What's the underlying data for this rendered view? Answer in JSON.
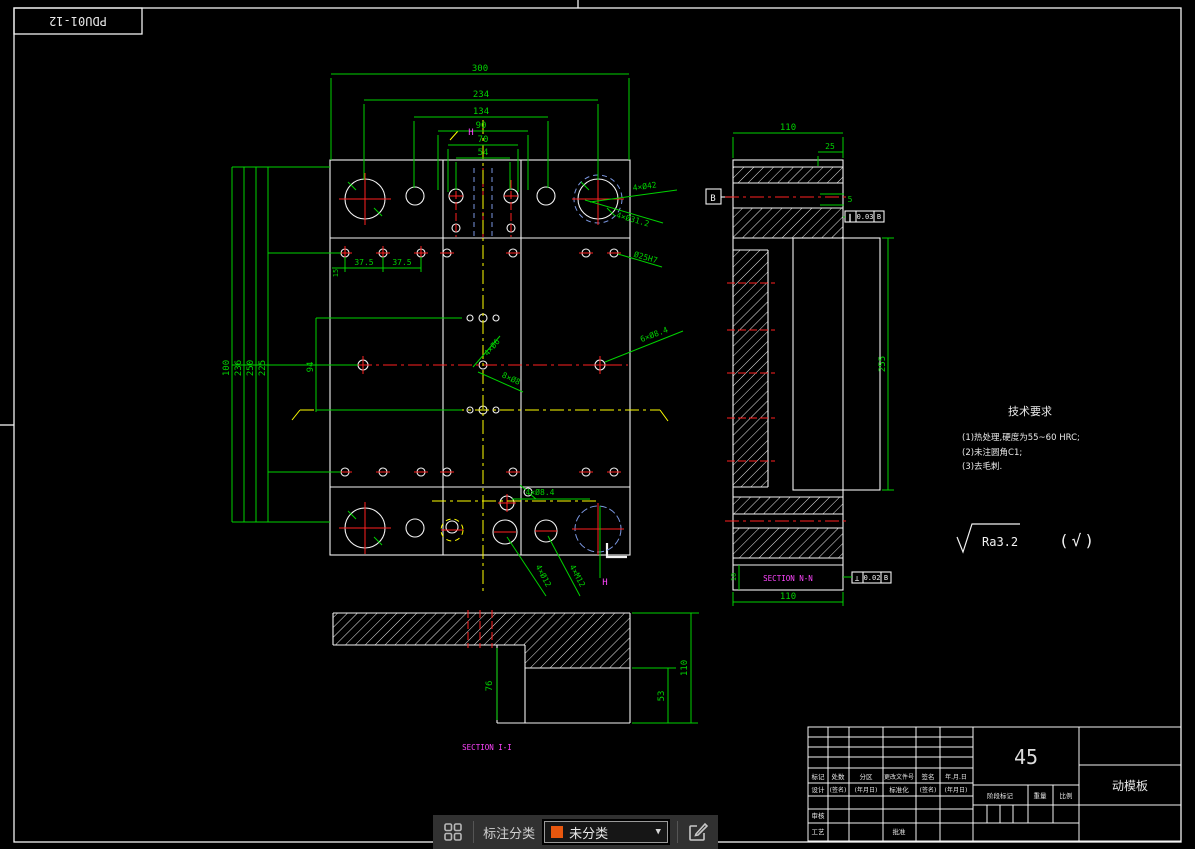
{
  "window": {
    "corner_label": "PDU01-12"
  },
  "plan_view": {
    "top_dims": [
      "300",
      "234",
      "134",
      "90",
      "70",
      "54"
    ],
    "left_dims": [
      "100",
      "236",
      "250",
      "225"
    ],
    "dim_94": "94",
    "dim_15": "15",
    "dim_375_a": "37.5",
    "dim_375_b": "37.5",
    "leaders": {
      "guide_outer": "4×Ø42",
      "guide_inner": "4×Ø31.2",
      "hole_right": "Ø25H7",
      "center_up": "4×Ø6",
      "center_down": "8×Ø8",
      "mid_right": "6×Ø8.4",
      "bottom_h": "4×Ø8.4",
      "bottom_d1": "4×Ø12",
      "bottom_d2": "4×M12"
    },
    "section_marks": {
      "h_top": "H",
      "h_bottom": "H"
    }
  },
  "side_view": {
    "dim_width": "110",
    "dim_25": "25",
    "dim_5": "5",
    "dim_height": "255",
    "dim_width_bottom": "110",
    "dim_10": "10",
    "datum_label": "B",
    "fcf_top": {
      "symbol": "∥",
      "tolerance": "0.03",
      "datum": "B"
    },
    "fcf_bottom": {
      "symbol": "⊥",
      "tolerance": "0.02",
      "datum": "B"
    },
    "section_label": "SECTION N-N"
  },
  "bottom_view": {
    "dim_76": "76",
    "dim_53": "53",
    "dim_110": "110",
    "section_label": "SECTION I-I"
  },
  "tech_req": {
    "title": "技术要求",
    "items": [
      "(1)热处理,硬度为55~60 HRC;",
      "(2)未注圆角C1;",
      "(3)去毛刺."
    ]
  },
  "surface_finish": {
    "ra": "Ra3.2",
    "bracket": "(√)"
  },
  "title_block": {
    "material": "45",
    "part_name": "动模板",
    "row_change": [
      "标记",
      "处数",
      "分区",
      "更改文件号",
      "签名",
      "年.月.日"
    ],
    "row_sign": [
      "设计",
      "(签名)",
      "(年月日)",
      "标准化",
      "(签名)",
      "(年月日)"
    ],
    "audit": "审核",
    "craft": "工艺",
    "approve": "批准",
    "stage_mark": "阶段标记",
    "weight": "重量",
    "scale": "比例"
  },
  "toolbar": {
    "category_label": "标注分类",
    "selected_category": "未分类",
    "swatch_color": "#e8570e"
  },
  "colors": {
    "dimension": "#00d200",
    "outline": "#f2f2f2",
    "centerline_red": "#ff2020",
    "centerline_yellow": "#ffff00",
    "section_label": "#ff45ff",
    "hidden_blue": "#7a96e0"
  }
}
